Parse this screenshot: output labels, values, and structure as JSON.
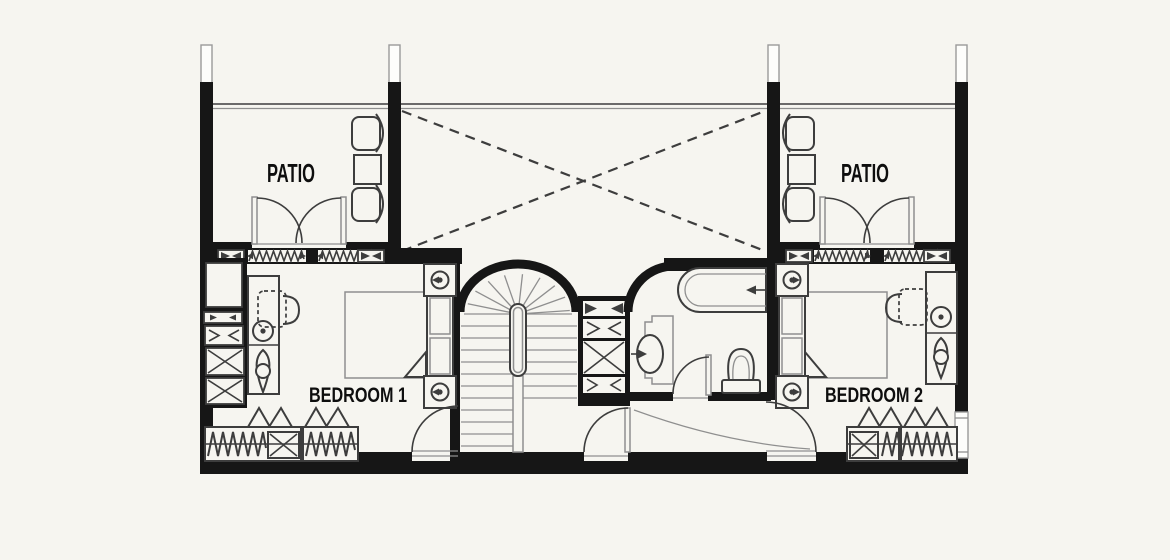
{
  "plan": {
    "labels": {
      "patio_left": "PATIO",
      "patio_right": "PATIO",
      "bedroom1": "BEDROOM 1",
      "bedroom2": "BEDROOM 2"
    },
    "fixtures": [
      "french-doors",
      "accordion-folding-doors",
      "patio-armchairs",
      "patio-side-table",
      "void-cross-dashed",
      "winder-staircase",
      "handrail",
      "bathtub",
      "washbasin",
      "toilet",
      "double-bed",
      "headboard",
      "bedside-lamp",
      "folded-sheet-corner",
      "desk-with-chair",
      "wardrobe-hanging-clothes",
      "window",
      "door-swing"
    ],
    "colors": {
      "paper": "#f6f5f0",
      "wall": "#161616",
      "line": "#3d3d3d",
      "light": "#8f8f8f",
      "text": "#0e0e0e"
    }
  }
}
